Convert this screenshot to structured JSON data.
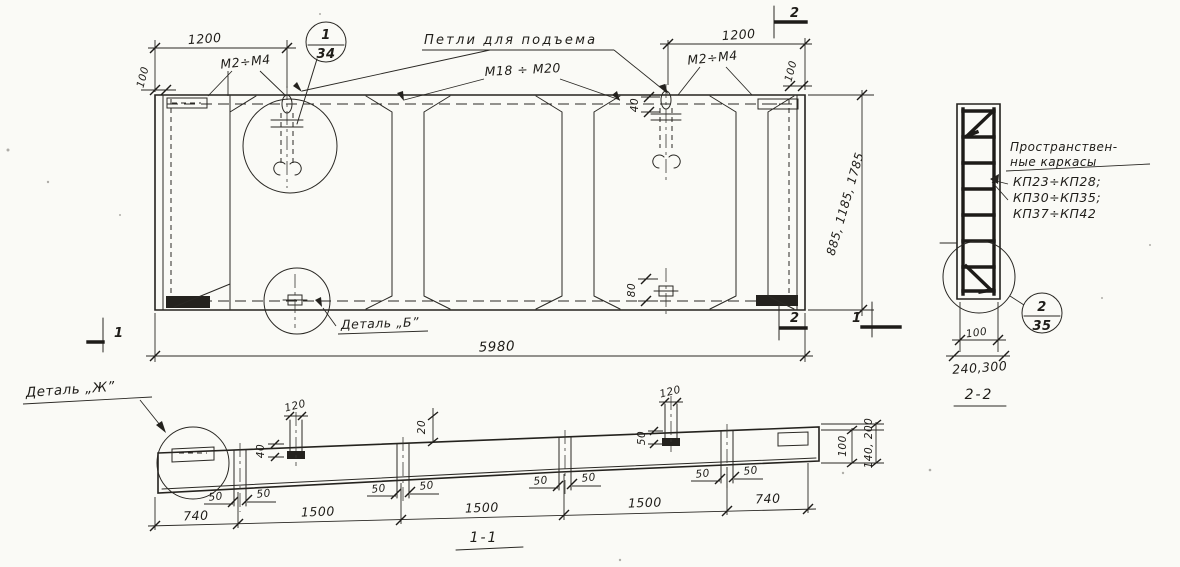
{
  "plan": {
    "dim_1200_left": "1200",
    "mark_m2m4_left": "М2÷М4",
    "dim_100_left": "100",
    "loops_callout": "Петли для подъема",
    "balloon_detail_num": "1",
    "balloon_sheet_num": "34",
    "mark_m18m20": "М18 ÷ М20",
    "dim_1200_right": "1200",
    "mark_m2m4_right": "М2÷М4",
    "dim_100_right": "100",
    "dim_40": "40",
    "dim_80": "80",
    "dim_widths": "885, 1185, 1785",
    "dim_length": "5980",
    "detail_b_label": "Деталь „Б”",
    "section1_mark": "1",
    "section2_mark": "2"
  },
  "section_1_1": {
    "title": "1-1",
    "detail_zh_label": "Деталь „Ж”",
    "dim_120": "120",
    "dim_40": "40",
    "dim_20": "20",
    "dim_50": "50",
    "dims_bottom": [
      "740",
      "1500",
      "1500",
      "1500",
      "740"
    ],
    "dim_100_end": "100",
    "dim_heights_end": "140, 200"
  },
  "section_2_2": {
    "title": "2-2",
    "callout_line1": "Пространствен-",
    "callout_line2": "ные каркасы",
    "cages_line1": "КП23÷КП28;",
    "cages_line2": "КП30÷КП35;",
    "cages_line3": "КП37÷КП42",
    "balloon_detail_num": "2",
    "balloon_sheet_num": "35",
    "dim_100": "100",
    "dim_240_300": "240,300"
  }
}
